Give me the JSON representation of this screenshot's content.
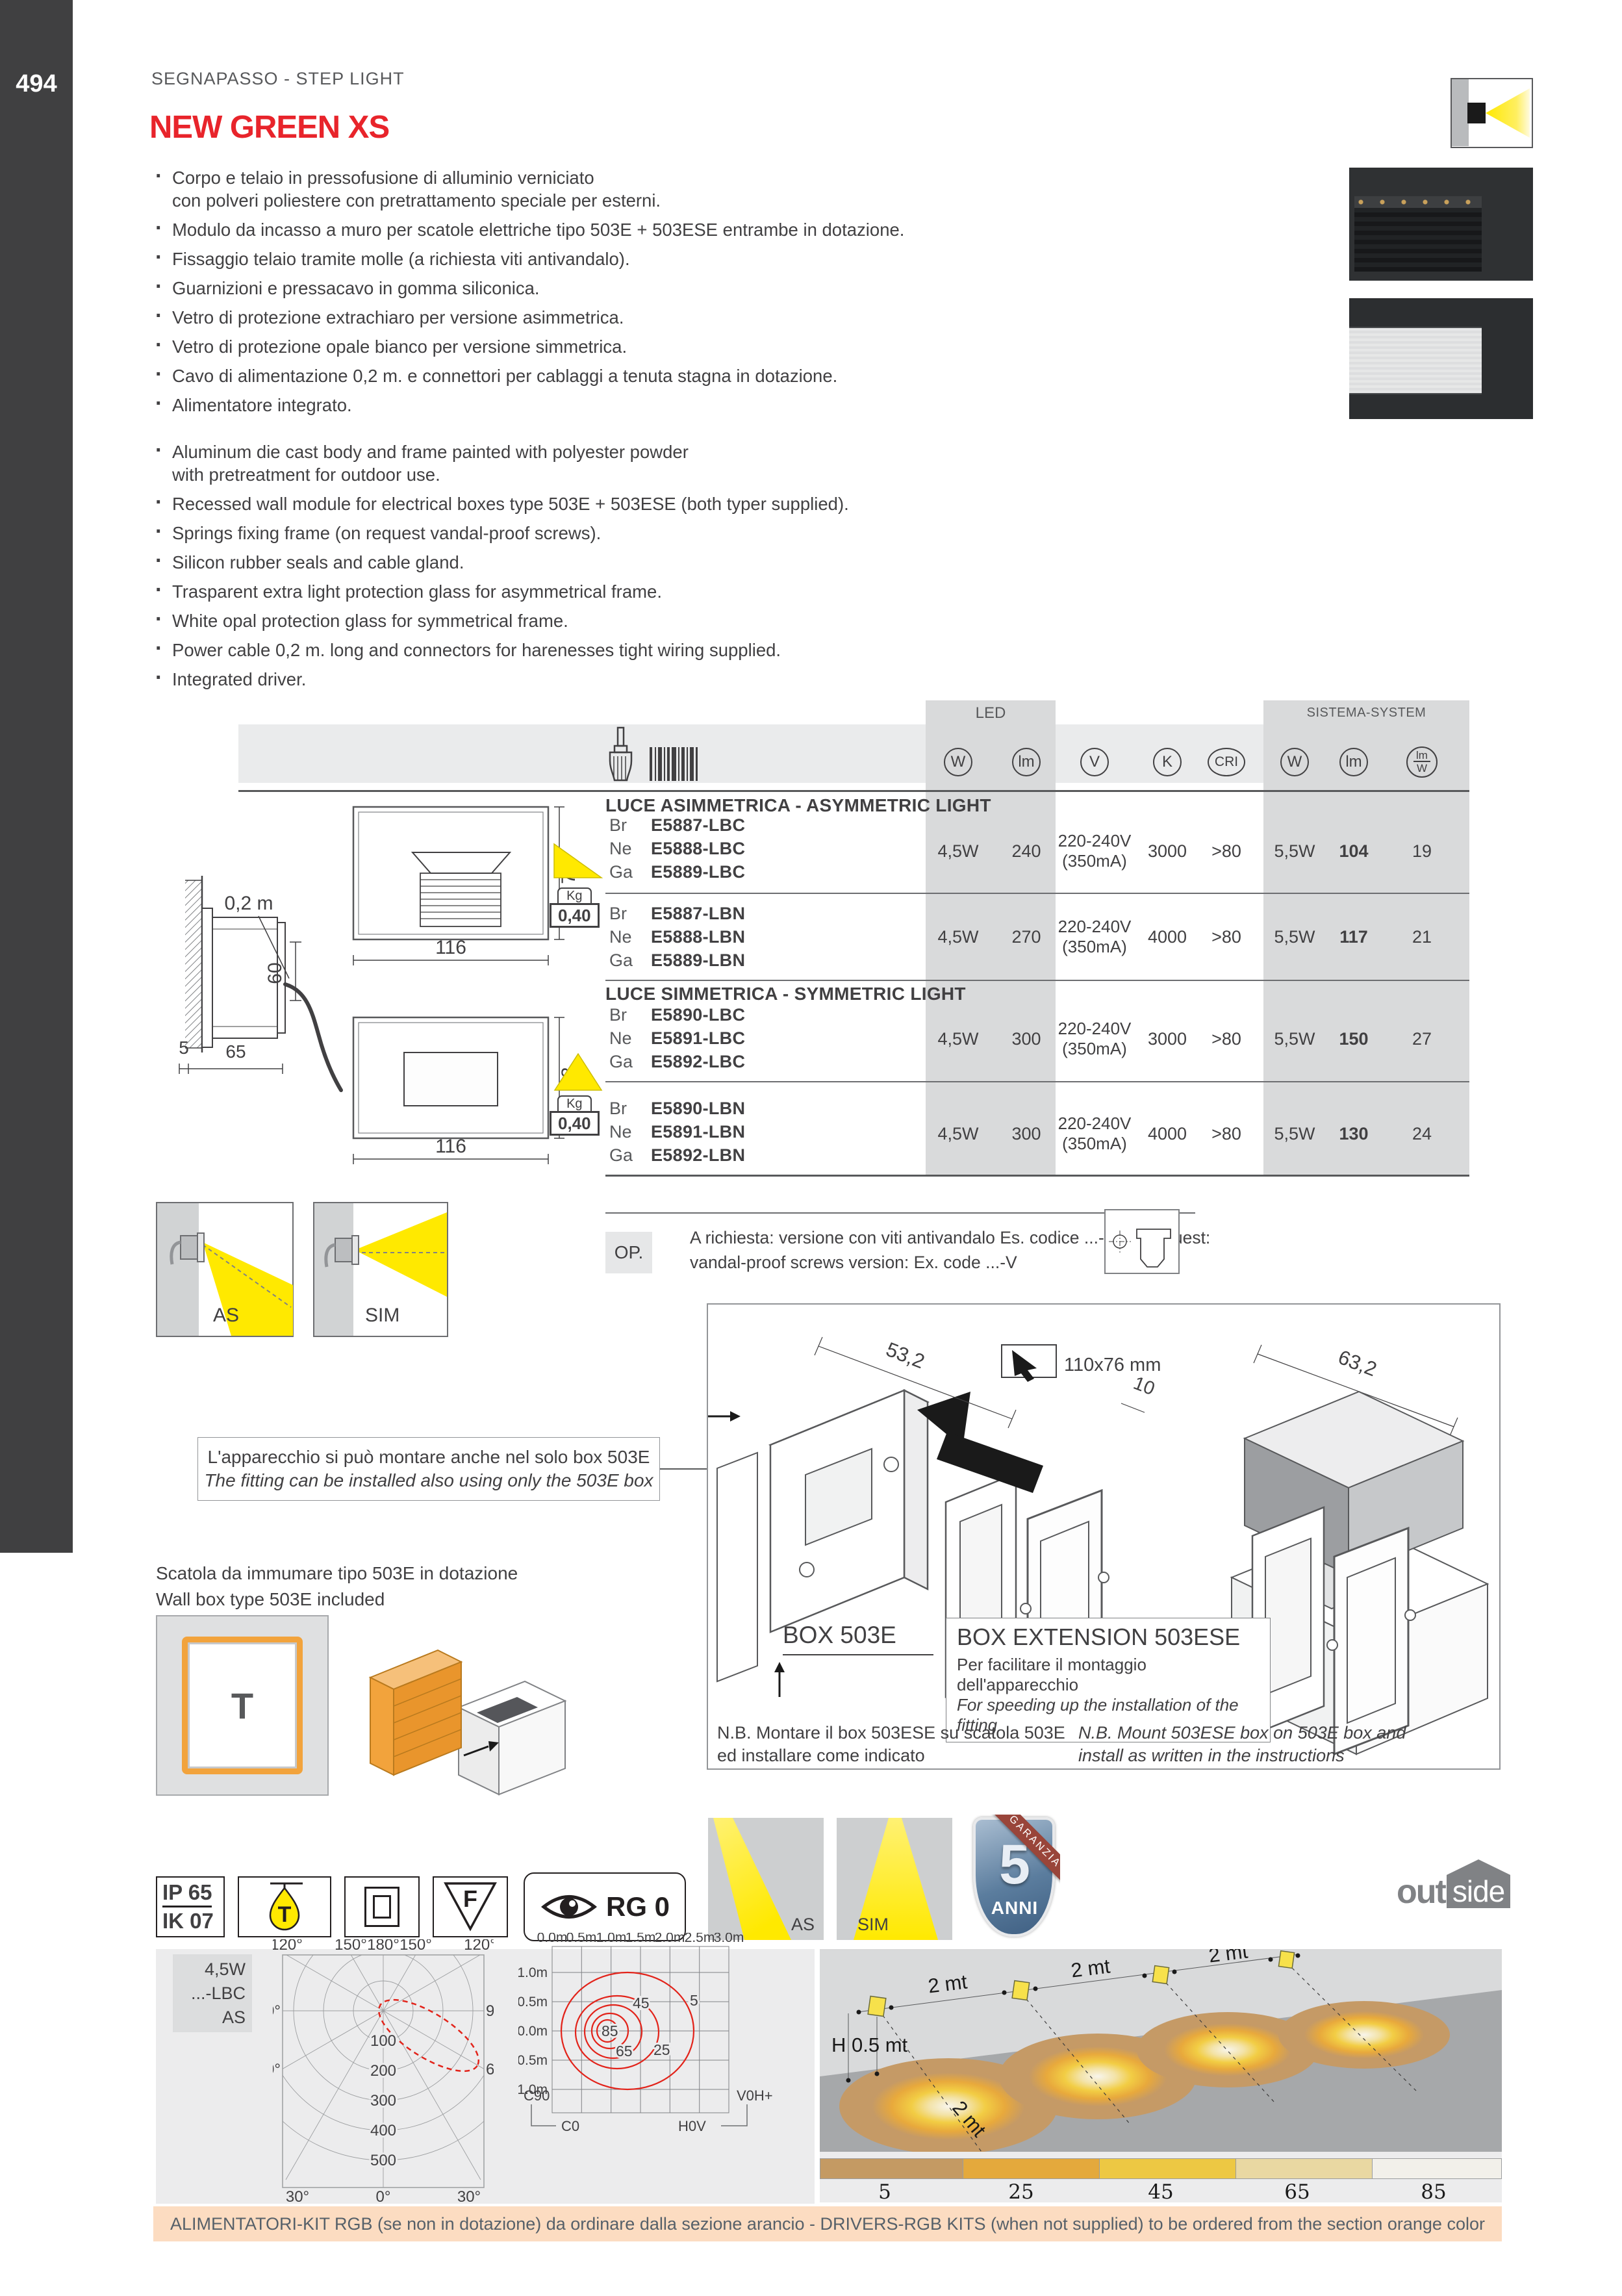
{
  "page": {
    "number": "494",
    "breadcrumb": "SEGNAPASSO - STEP LIGHT",
    "title": "NEW GREEN XS"
  },
  "features_it": [
    "Corpo e telaio in pressofusione di alluminio verniciato\ncon polveri poliestere con pretrattamento speciale per esterni.",
    "Modulo da incasso a muro per scatole elettriche tipo 503E + 503ESE entrambe in dotazione.",
    "Fissaggio telaio tramite molle (a richiesta viti antivandalo).",
    "Guarnizioni e pressacavo in gomma siliconica.",
    "Vetro di protezione extrachiaro per versione asimmetrica.",
    "Vetro di protezione opale bianco per versione simmetrica.",
    "Cavo di alimentazione 0,2 m. e connettori per cablaggi a tenuta stagna in dotazione.",
    "Alimentatore integrato."
  ],
  "features_en": [
    "Aluminum die cast body and frame painted with polyester powder\nwith pretreatment for outdoor use.",
    "Recessed wall module for electrical boxes type 503E + 503ESE (both typer supplied).",
    "Springs fixing frame (on request vandal-proof screws).",
    "Silicon rubber seals and cable gland.",
    "Trasparent extra light protection glass for asymmetrical frame.",
    "White opal protection glass for symmetrical frame.",
    "Power cable 0,2 m. long and connectors for harenesses tight wiring supplied.",
    "Integrated driver."
  ],
  "table": {
    "group1": "LED",
    "group2": "SISTEMA-SYSTEM",
    "col_w": "W",
    "col_lm": "lm",
    "col_v": "V",
    "col_k": "K",
    "col_cri": "CRI",
    "col_w2": "W",
    "col_lm2": "lm",
    "col_frac_top": "lm",
    "col_frac_bot": "W",
    "sect1": "LUCE ASIMMETRICA - ASYMMETRIC LIGHT",
    "sect2": "LUCE SIMMETRICA - SYMMETRIC LIGHT",
    "rows": [
      {
        "fin1": "Br",
        "code1": "E5887-LBC",
        "fin2": "Ne",
        "code2": "E5888-LBC",
        "fin3": "Ga",
        "code3": "E5889-LBC",
        "led_w": "4,5W",
        "led_lm": "240",
        "volt": "220-240V",
        "amp": "(350mA)",
        "k": "3000",
        "cri": ">80",
        "sys_w": "5,5W",
        "sys_lm": "104",
        "lmw": "19"
      },
      {
        "fin1": "Br",
        "code1": "E5887-LBN",
        "fin2": "Ne",
        "code2": "E5888-LBN",
        "fin3": "Ga",
        "code3": "E5889-LBN",
        "led_w": "4,5W",
        "led_lm": "270",
        "volt": "220-240V",
        "amp": "(350mA)",
        "k": "4000",
        "cri": ">80",
        "sys_w": "5,5W",
        "sys_lm": "117",
        "lmw": "21"
      },
      {
        "fin1": "Br",
        "code1": "E5890-LBC",
        "fin2": "Ne",
        "code2": "E5891-LBC",
        "fin3": "Ga",
        "code3": "E5892-LBC",
        "led_w": "4,5W",
        "led_lm": "300",
        "volt": "220-240V",
        "amp": "(350mA)",
        "k": "3000",
        "cri": ">80",
        "sys_w": "5,5W",
        "sys_lm": "150",
        "lmw": "27"
      },
      {
        "fin1": "Br",
        "code1": "E5890-LBN",
        "fin2": "Ne",
        "code2": "E5891-LBN",
        "fin3": "Ga",
        "code3": "E5892-LBN",
        "led_w": "4,5W",
        "led_lm": "300",
        "volt": "220-240V",
        "amp": "(350mA)",
        "k": "4000",
        "cri": ">80",
        "sys_w": "5,5W",
        "sys_lm": "130",
        "lmw": "24"
      }
    ]
  },
  "drawings": {
    "d116": "116",
    "d73": "73",
    "d02": "0,2 m",
    "d60": "60",
    "d5": "5",
    "d65": "65",
    "kg": "Kg",
    "kgv": "0,40",
    "as": "AS",
    "sim": "SIM"
  },
  "op": {
    "label": "OP.",
    "line1": "A richiesta: versione con viti antivandalo Es. codice ...-V  On request:",
    "line2": "vandal-proof screws version: Ex. code ...-V"
  },
  "install": {
    "d53": "53,2",
    "chip": "110x76 mm",
    "d10": "10",
    "d63": "63,2",
    "box1": "BOX 503E",
    "box2_title": "BOX EXTENSION  503ESE",
    "box2_it": "Per facilitare il montaggio dell'apparecchio",
    "box2_en": "For speeding up the installation of the fitting",
    "nb_it1": "N.B. Montare il box 503ESE su scatola 503E",
    "nb_it2": "ed installare come indicato",
    "nb_en1": "N.B. Mount 503ESE box on 503E box and",
    "nb_en2": "install as written in the instructions",
    "note_it": "L'apparecchio si può montare anche nel solo box 503E",
    "note_en": "The fitting can be installed also using only the 503E box",
    "wb_it": "Scatola da immumare tipo 503E in dotazione",
    "wb_en": "Wall box type 503E included",
    "t": "T"
  },
  "badges": {
    "ip": "IP 65",
    "ik": "IK 07",
    "f": "F",
    "rg": "RG 0",
    "as": "AS",
    "sim": "SIM",
    "five": "5",
    "anni": "ANNI",
    "garanzia": "GARANZIA"
  },
  "logo": {
    "out": "out",
    "side": "side"
  },
  "polar": {
    "chip1": "4,5W",
    "chip2": "...-LBC",
    "chip3": "AS",
    "top": [
      "120°",
      "150°",
      "180°",
      "150°",
      "120°"
    ],
    "l90": "90°",
    "r90": "90°",
    "l60": "60°",
    "r60": "60°",
    "l30": "30°",
    "r30": "30°",
    "zero": "0°",
    "r": [
      "100",
      "200",
      "300",
      "400",
      "500"
    ],
    "leg": [
      "C180",
      "C00",
      "C270",
      "C90"
    ]
  },
  "isolux": {
    "x": [
      "0.0m",
      "0.5m",
      "1.0m",
      "1.5m",
      "2.0m",
      "2.5m",
      "3.0m"
    ],
    "y": [
      "1.0m",
      "0.5m",
      "0.0m",
      "-0.5m",
      "-1.0m"
    ],
    "c45": "45",
    "c5": "5",
    "c85": "85",
    "c65": "65",
    "c25": "25",
    "c90": "C90",
    "c0": "C0",
    "h0v": "H0V",
    "v0h": "V0H+"
  },
  "scene": {
    "mt": "2 mt",
    "h": "H 0.5 mt"
  },
  "scale": {
    "v": [
      "5",
      "25",
      "45",
      "65",
      "85"
    ],
    "colors": [
      "#c49a63",
      "#e4a93c",
      "#edc843",
      "#e9d8a2",
      "#f2f0ea"
    ]
  },
  "footer": {
    "text": "ALIMENTATORI-KIT RGB (se non in dotazione) da ordinare dalla sezione arancio - DRIVERS-RGB KITS (when not supplied) to be ordered from the section orange color"
  },
  "chart_data": [
    {
      "type": "line",
      "subtype": "polar_luminous_intensity",
      "title": "4,5W ...-LBC AS",
      "angle_ticks": [
        "0°",
        "30°",
        "60°",
        "90°",
        "120°",
        "150°",
        "180°"
      ],
      "radial_ticks_cd": [
        100,
        200,
        300,
        400,
        500
      ],
      "legend": [
        {
          "name": "C180-C00",
          "style": "dashed red"
        },
        {
          "name": "C270-C90",
          "style": "solid red"
        }
      ],
      "series": [
        {
          "name": "C00 plane asymmetric lobe",
          "description": "single lobe from pole toward 60°-90° quadrant, peak ≈ 230 cd at ≈ 65°"
        }
      ]
    },
    {
      "type": "heatmap",
      "subtype": "isolux_contours",
      "x_ticks_m": [
        0.0,
        0.5,
        1.0,
        1.5,
        2.0,
        2.5,
        3.0
      ],
      "y_ticks_m": [
        1.0,
        0.5,
        0.0,
        -0.5,
        -1.0
      ],
      "contour_levels_lux": [
        85,
        65,
        45,
        25,
        5
      ],
      "contour_center_m": [
        0.6,
        0.0
      ],
      "planes": {
        "bottom_left": "C90",
        "bottom": "C0",
        "bottom_right": "H0V",
        "right": "V0H+"
      }
    },
    {
      "type": "heatmap",
      "subtype": "floor_illuminance_scale",
      "levels_lux": [
        5,
        25,
        45,
        65,
        85
      ],
      "colors": [
        "#c49a63",
        "#e4a93c",
        "#edc843",
        "#e9d8a2",
        "#f2f0ea"
      ],
      "fixture_spacing": "2 mt",
      "mounting_height": "H 0.5 mt"
    }
  ]
}
